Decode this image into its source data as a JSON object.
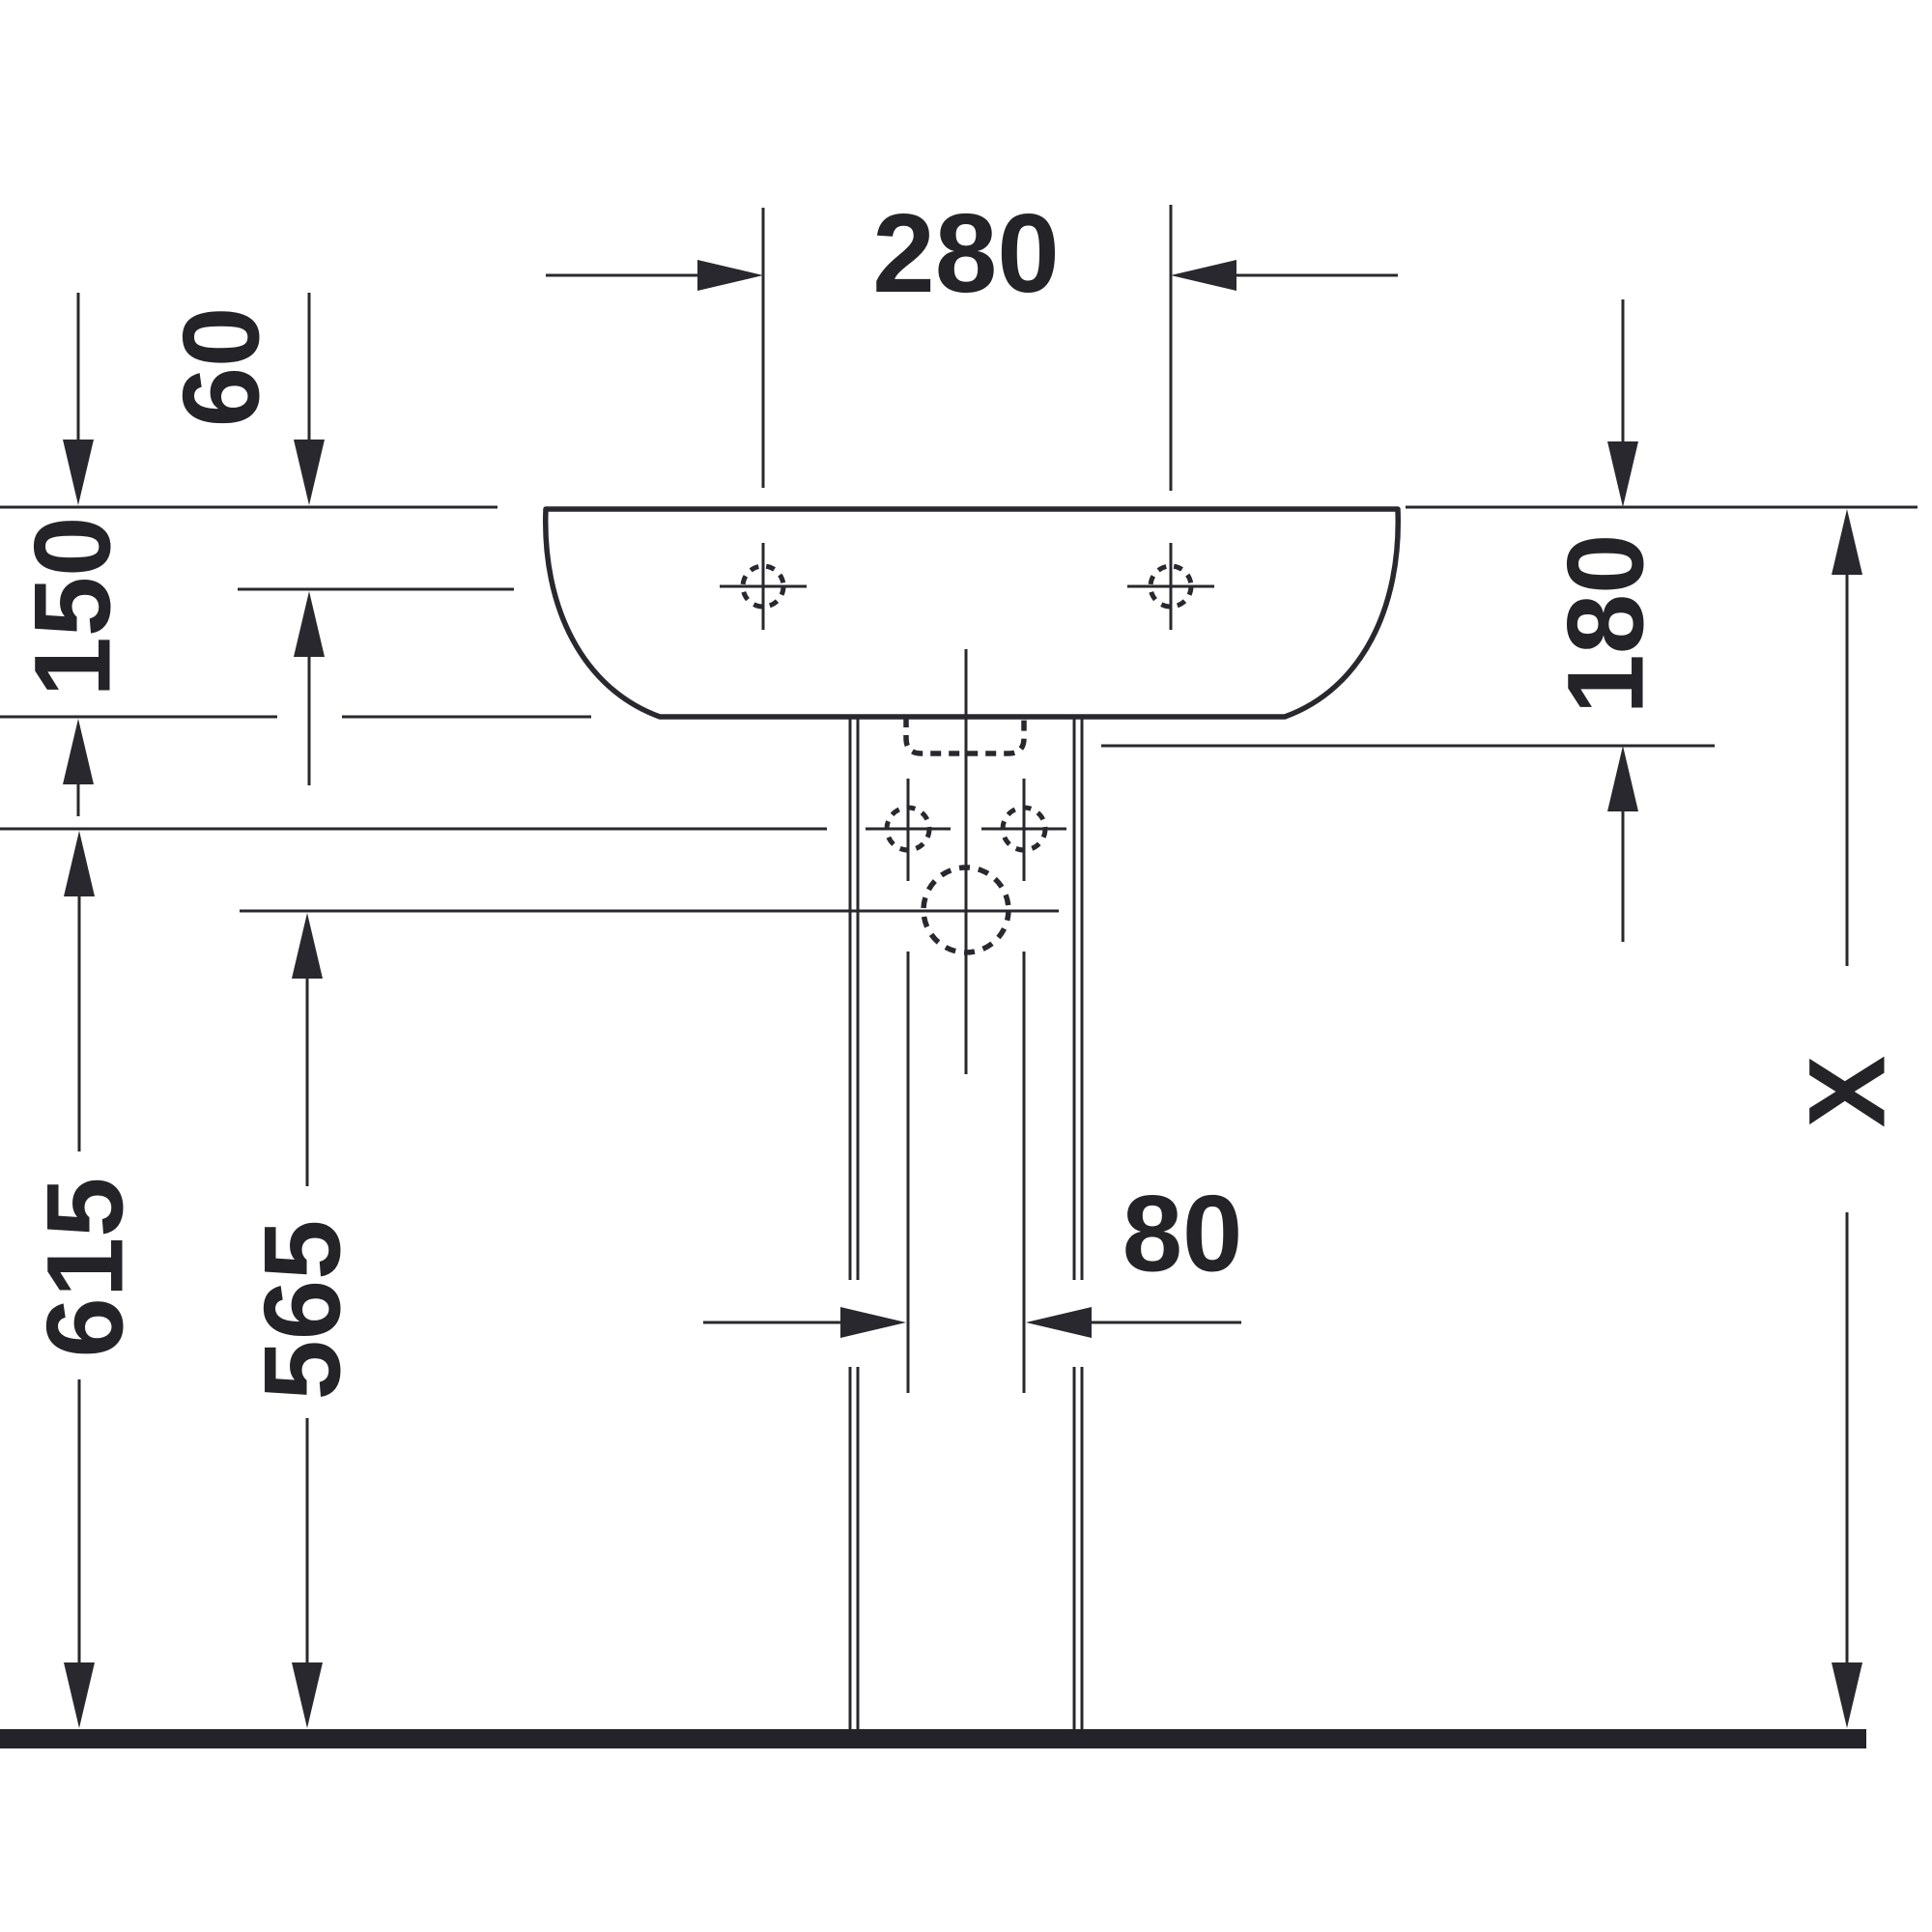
{
  "drawing": {
    "type": "technical-dimension-drawing",
    "subject": "pedestal washbasin, front elevation with installation dimensions",
    "units": "mm",
    "ink_color": "#28282e",
    "floor_color": "#232329",
    "background_color": "#ffffff",
    "dimensions": {
      "tap_hole_spacing": {
        "label": "280",
        "value_mm": 280,
        "orientation": "horizontal"
      },
      "rim_to_tap_hole": {
        "label": "60",
        "value_mm": 60,
        "orientation": "vertical"
      },
      "basin_front_height": {
        "label": "150",
        "value_mm": 150,
        "orientation": "vertical"
      },
      "rim_to_back_ledge": {
        "label": "180",
        "value_mm": 180,
        "orientation": "vertical"
      },
      "fixing_hole_height": {
        "label": "615",
        "value_mm": 615,
        "orientation": "vertical"
      },
      "drain_center_height": {
        "label": "565",
        "value_mm": 565,
        "orientation": "vertical"
      },
      "pedestal_channel_width": {
        "label": "80",
        "value_mm": 80,
        "orientation": "horizontal"
      },
      "rim_height_variable": {
        "label": "X",
        "value_mm": null,
        "orientation": "vertical"
      }
    },
    "features": [
      "basin-outline",
      "left-tap-hole",
      "right-tap-hole",
      "overflow-slot",
      "drain-hole",
      "left-fixing-hole",
      "right-fixing-hole",
      "pedestal",
      "floor-line"
    ]
  }
}
